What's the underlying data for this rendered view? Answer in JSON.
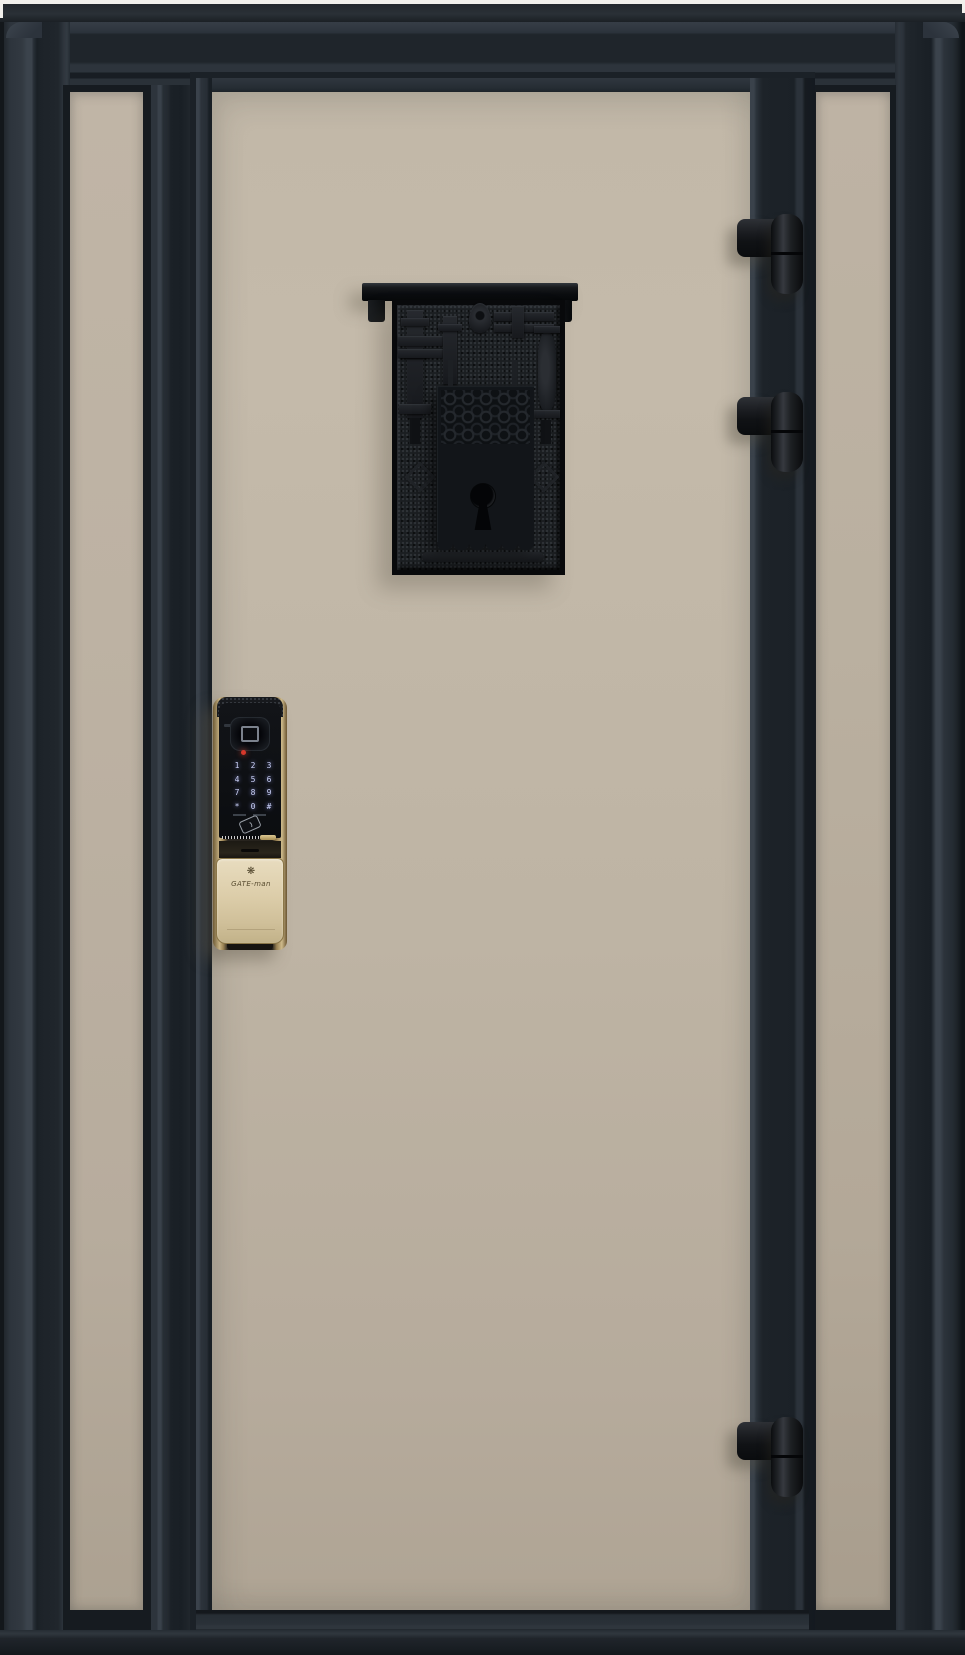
{
  "scene": {
    "description": "Product photo of a charcoal steel security entry door with two beige sidelight panels, an antique black escutcheon plate with keyhole, a push-pull smart door lock, and three barrel hinges",
    "background_color": "#f2f0ec"
  },
  "palette": {
    "frame_dark": "#262d34",
    "frame_darker": "#1a2026",
    "frame_highlight": "#3b434c",
    "panel_beige": "#beb4a4",
    "sidelight_beige": "#b7ac9d",
    "hardware_black": "#121417",
    "lock_gold": "#c9b485",
    "lock_champagne": "#dccda9",
    "lock_face_black": "#0c0e11",
    "keypad_glow": "#c9cff5",
    "led_red": "#d7382b"
  },
  "door": {
    "panels": [
      {
        "name": "left-sidelight"
      },
      {
        "name": "main-door-panel"
      },
      {
        "name": "right-sidelight"
      }
    ],
    "hinge_count": 3
  },
  "ornamental_plate": {
    "style": "antique textured escutcheon with roof lintel, scrollwork drop panel and keyhole"
  },
  "smart_lock": {
    "brand": "GATE-man",
    "logo_glyph": "❋",
    "keypad": [
      "1",
      "2",
      "3",
      "4",
      "5",
      "6",
      "7",
      "8",
      "9",
      "*",
      "0",
      "#"
    ],
    "led_color": "#d7382b"
  }
}
